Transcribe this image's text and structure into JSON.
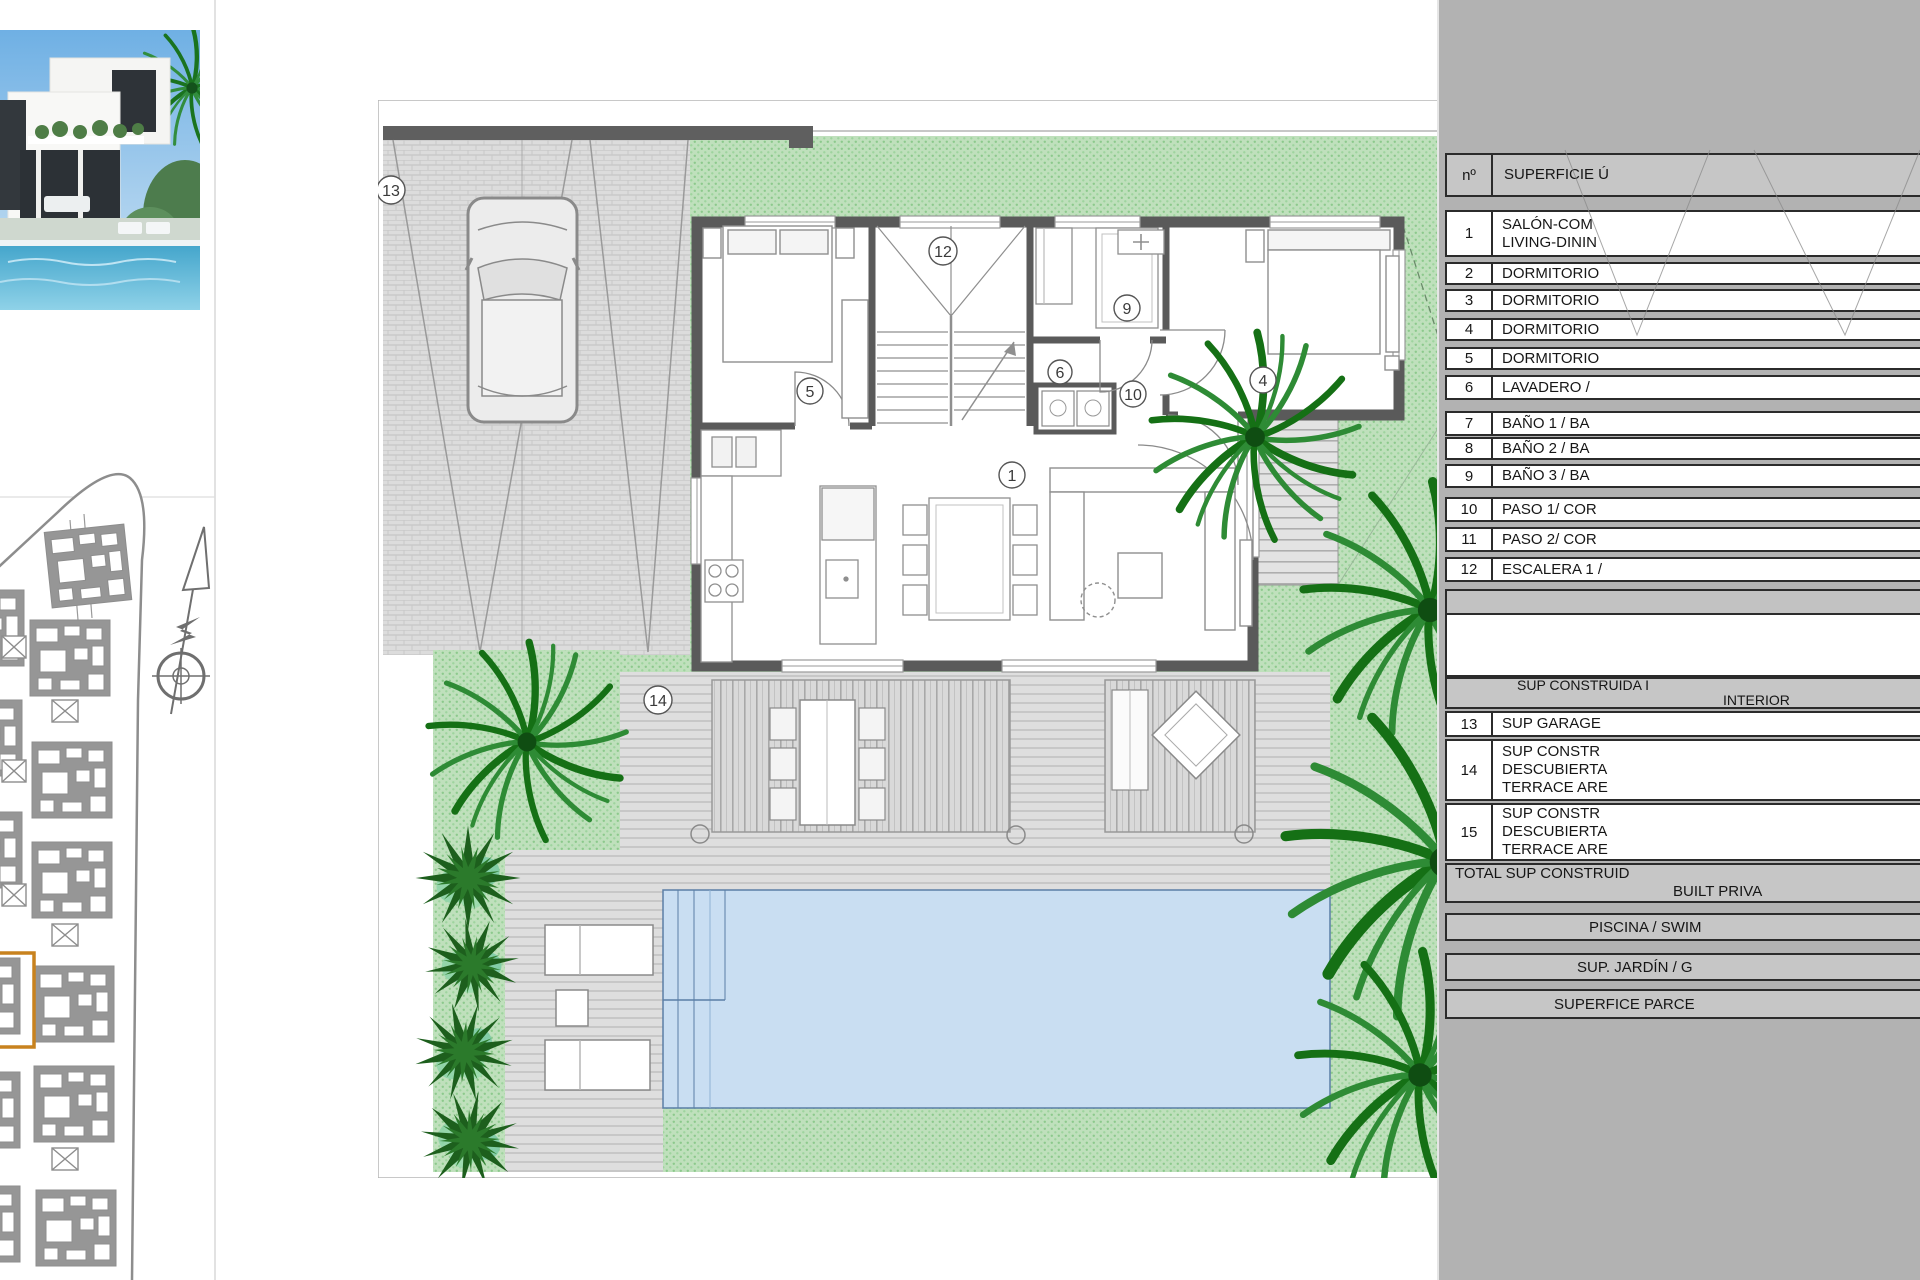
{
  "sheet": {
    "type": "villa-ground-floor-plan",
    "colors": {
      "sidebar_bg": "#b2b2b2",
      "table_gray": "#c6c6c6",
      "garden_green": "#bfe0bc",
      "garden_dot": "#8cc98c",
      "palm_dark": "#157015",
      "palm_mid": "#2e8b35",
      "pool_blue": "#c9def2",
      "wall_gray": "#5a5a5a",
      "paving_gray": "#dedede",
      "highlight_orange": "#c8821e"
    }
  },
  "plan": {
    "labels": [
      {
        "num": "13"
      },
      {
        "num": "12"
      },
      {
        "num": "5"
      },
      {
        "num": "9"
      },
      {
        "num": "6"
      },
      {
        "num": "10"
      },
      {
        "num": "4"
      },
      {
        "num": "1"
      },
      {
        "num": "14"
      }
    ]
  },
  "sidebar": {
    "table": {
      "header": {
        "col1": "nº",
        "col2": "SUPERFICIE Ú"
      },
      "rows": [
        {
          "n": "1",
          "lines": [
            "SALÓN-COM",
            "LIVING-DININ"
          ]
        },
        {
          "n": "2",
          "lines": [
            "DORMITORIO"
          ]
        },
        {
          "n": "3",
          "lines": [
            "DORMITORIO"
          ]
        },
        {
          "n": "4",
          "lines": [
            "DORMITORIO"
          ]
        },
        {
          "n": "5",
          "lines": [
            "DORMITORIO"
          ]
        },
        {
          "n": "6",
          "lines": [
            "LAVADERO /"
          ]
        },
        {
          "n": "7",
          "lines": [
            "BAÑO 1 / BA"
          ]
        },
        {
          "n": "8",
          "lines": [
            "BAÑO 2 / BA"
          ]
        },
        {
          "n": "9",
          "lines": [
            "BAÑO 3 / BA"
          ]
        },
        {
          "n": "10",
          "lines": [
            "PASO 1/ COR"
          ]
        },
        {
          "n": "11",
          "lines": [
            "PASO 2/ COR"
          ]
        },
        {
          "n": "12",
          "lines": [
            "ESCALERA 1 /"
          ]
        }
      ],
      "section2_header": {
        "lines": [
          "SUP CONSTRUIDA I",
          "INTERIOR"
        ]
      },
      "rows2": [
        {
          "n": "13",
          "lines": [
            "SUP GARAGE"
          ]
        },
        {
          "n": "14",
          "lines": [
            "SUP CONSTR",
            "DESCUBIERTA",
            "TERRACE ARE"
          ]
        },
        {
          "n": "15",
          "lines": [
            "SUP CONSTR",
            "DESCUBIERTA",
            "TERRACE ARE"
          ]
        }
      ],
      "total_row": {
        "lines": [
          "TOTAL SUP CONSTRUID",
          "BUILT PRIVA"
        ]
      },
      "summary_rows": [
        "PISCINA / SWIM",
        "SUP. JARDÍN / G",
        "SUPERFICE PARCE"
      ]
    }
  }
}
